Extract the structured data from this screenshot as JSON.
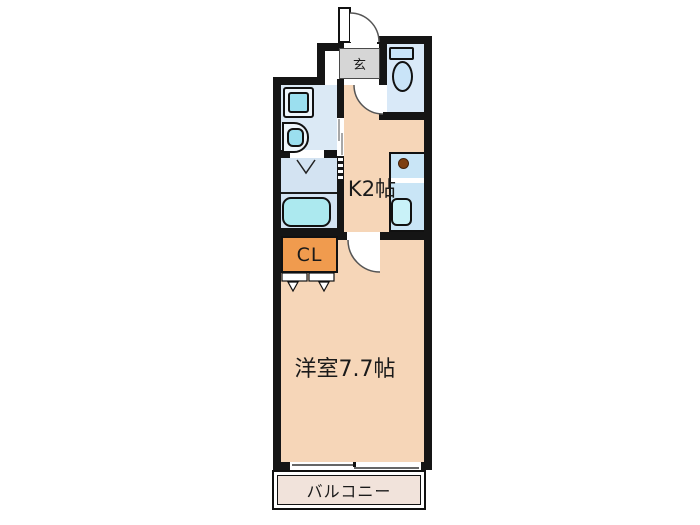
{
  "page": {
    "type": "apartment-floor-plan",
    "background": "#ffffff"
  },
  "rooms": {
    "entrance": {
      "label": "玄"
    },
    "kitchen": {
      "label": "K2帖"
    },
    "closet": {
      "label": "CL"
    },
    "western_room": {
      "label": "洋室7.7帖"
    },
    "balcony": {
      "label": "バルコニー"
    }
  },
  "fixtures": {
    "front_door": "swing-door",
    "toilet_door": "swing-door",
    "room_door": "swing-door",
    "washroom_door": "sliding-door",
    "bath_door": "folding-door",
    "closet_doors": "folding-doors",
    "toilet": "toilet-with-tank",
    "washing_machine_pan": "washing-machine-pan",
    "washbasin": "washbasin",
    "bathtub": "bathtub",
    "kitchen_counter": "kitchen-counter",
    "stove_burner": "single-burner",
    "kitchen_sink": "kitchen-sink",
    "balcony_window": "sliding-window"
  },
  "colors": {
    "wall": "#151515",
    "room_floor": "#F6D6B8",
    "washroom_floor": "#DBE9F5",
    "bath_floor": "#D3E3F2",
    "toilet_floor": "#D9E9F8",
    "fixture_cyan": "#9BDFEF",
    "counter_blue": "#C9E5F6",
    "closet_orange": "#F09B4E",
    "entrance_gray": "#D6D6D6",
    "balcony_beige": "#F1E3DB",
    "burner_brown": "#7E4012"
  }
}
